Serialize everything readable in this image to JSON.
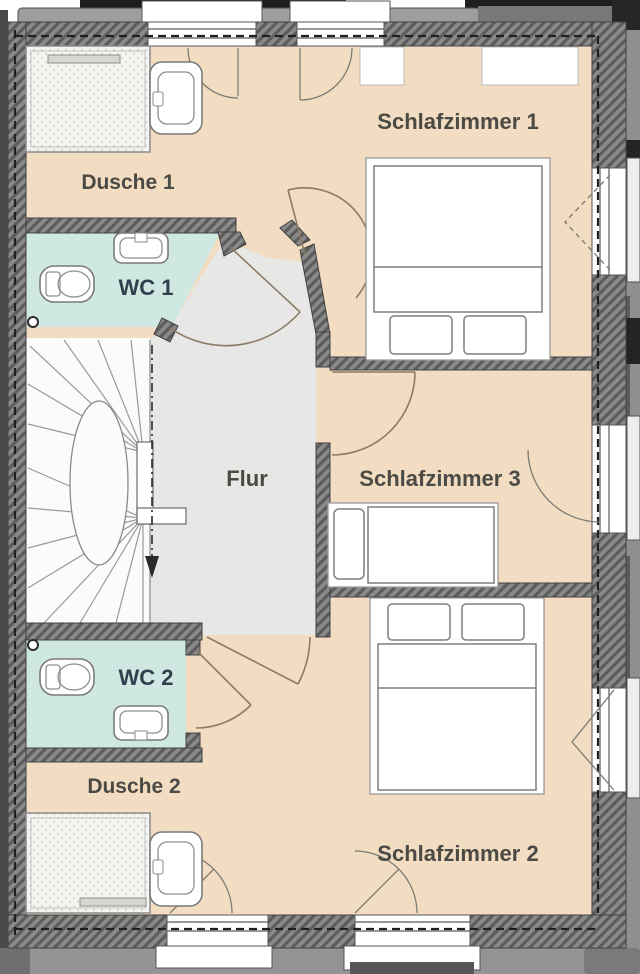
{
  "plan": {
    "type": "floor-plan",
    "floor": "upper-floor",
    "rooms": [
      {
        "id": "schlafzimmer1",
        "label": "Schlafzimmer 1",
        "floor_color": "#f2dcc2"
      },
      {
        "id": "dusche1",
        "label": "Dusche 1",
        "floor_color": "#f2dcc2"
      },
      {
        "id": "wc1",
        "label": "WC 1",
        "floor_color": "#cfe9e2"
      },
      {
        "id": "flur",
        "label": "Flur",
        "floor_color": "#e7e7e5"
      },
      {
        "id": "schlafzimmer3",
        "label": "Schlafzimmer 3",
        "floor_color": "#f2dcc2"
      },
      {
        "id": "wc2",
        "label": "WC 2",
        "floor_color": "#cfe9e2"
      },
      {
        "id": "dusche2",
        "label": "Dusche 2",
        "floor_color": "#f2dcc2"
      },
      {
        "id": "schlafzimmer2",
        "label": "Schlafzimmer 2",
        "floor_color": "#f2dcc2"
      }
    ],
    "colors": {
      "bedroom_floor": "#f2dcc2",
      "hall_floor": "#e7e7e5",
      "wc_floor": "#cfe9e2",
      "stair_floor": "#fbfbfb",
      "wall_hatch": "#8a8a8a",
      "wall_hatch_dark": "#5c5c5c",
      "exterior_trim": "#9e9e9e",
      "label_color": "#4b4a44",
      "wc_label_color": "#30404e",
      "door_arc": "#8c7b66"
    },
    "fixtures": [
      "shower-tray",
      "washbasin",
      "toilet",
      "double-bed",
      "single-bed",
      "winder-staircase",
      "down-pipe"
    ],
    "symbols": [
      "door-swing-arc",
      "window-swing-arc",
      "tilt-window-triangle",
      "knee-wall-dashed-line",
      "stair-walk-line-arrow"
    ]
  }
}
